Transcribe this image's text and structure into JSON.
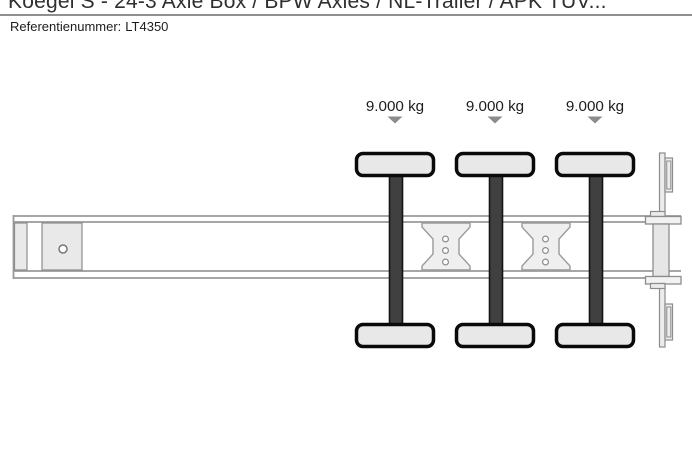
{
  "page": {
    "title": "Koegel S - 24-3 Axle Box / BPW Axles / NL-Trailer / APK TÜV...",
    "reference_label": "Referentienummer:",
    "reference_value": "LT4350"
  },
  "diagram": {
    "type": "trailer-chassis-top-view-axle-load-schematic",
    "axle_count": 3,
    "axles": [
      {
        "position": 1,
        "load_label": "9.000 kg"
      },
      {
        "position": 2,
        "load_label": "9.000 kg"
      },
      {
        "position": 3,
        "load_label": "9.000 kg"
      }
    ]
  },
  "colors": {
    "frame_line": "#9a9a9a",
    "wheel_fill": "#e8e8e8",
    "wheel_outline": "#0a0a0a",
    "axle_fill": "#404040",
    "arrow": "#8c8c8c",
    "text": "#1c1c1c"
  }
}
